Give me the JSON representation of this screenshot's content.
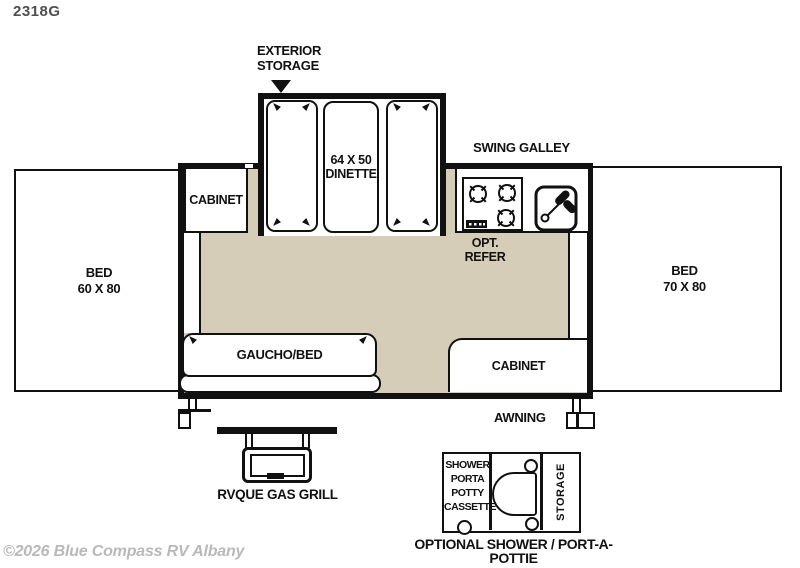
{
  "model_label": "2318G",
  "watermark": "©2026 Blue Compass RV Albany",
  "colors": {
    "floor": "#d6cdb8",
    "line": "#111111",
    "watermark_text": "#b9b9b9",
    "model_text": "#4f4f4f"
  },
  "annotations": {
    "exterior_storage": "EXTERIOR\nSTORAGE",
    "swing_galley": "SWING GALLEY",
    "dinette": "64 X 50\nDINETTE",
    "opt_refer": "OPT.\nREFER",
    "cabinet_top": "CABINET",
    "bed_left": "BED\n60 X 80",
    "bed_right": "BED\n70 X 80",
    "gaucho_bed": "GAUCHO/BED",
    "cabinet_bottom": "CABINET",
    "awning": "AWNING",
    "rvque_gas_grill": "RVQUE GAS GRILL",
    "shower_stack": "SHOWER\nPORTA\nPOTTY\nCASSETTE",
    "storage": "STORAGE",
    "optional_shower": "OPTIONAL SHOWER / PORT-A-POTTIE"
  }
}
